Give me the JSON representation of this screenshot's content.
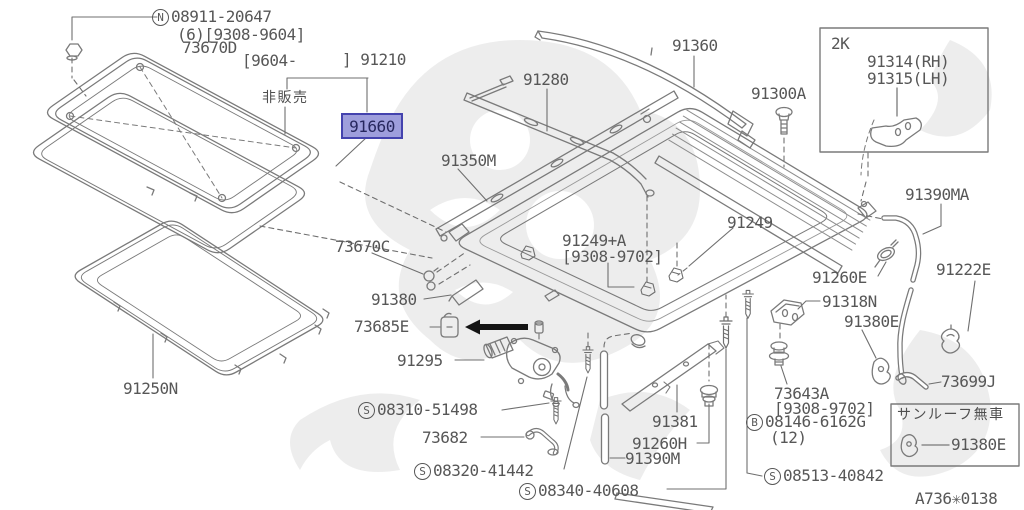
{
  "diagram_code": "A736✳0138",
  "highlight": {
    "part": "91660"
  },
  "colors": {
    "line": "#7a7a7a",
    "text": "#575757",
    "watermark": "#e4e4e4",
    "highlight_bg": "#9e9edc",
    "highlight_border": "#4443ae",
    "highlight_text": "#27275e",
    "arrow": "#141414"
  },
  "boxes": {
    "rh_lh_variant": {
      "tag": "2K"
    },
    "no_sunroof_variant": {
      "title": "サンルーフ無車"
    }
  },
  "labels": [
    {
      "name": "part-08911-20647",
      "prefix": "N",
      "text": "08911-20647",
      "x": 152,
      "y": 8,
      "inter": true
    },
    {
      "name": "note-08911-qty-range",
      "text": "(6)[9308-9604]",
      "x": 177,
      "y": 26,
      "inter": false
    },
    {
      "name": "part-73670d",
      "text": "73670D",
      "x": 182,
      "y": 39,
      "inter": true
    },
    {
      "name": "note-date-open",
      "text": "[9604-",
      "x": 242,
      "y": 52,
      "inter": false
    },
    {
      "name": "part-91210",
      "text": "] 91210",
      "x": 342,
      "y": 51,
      "inter": true
    },
    {
      "name": "note-not-sold",
      "text": "非販売",
      "x": 262,
      "y": 90,
      "cls": "jp",
      "inter": false
    },
    {
      "name": "part-91360",
      "text": "91360",
      "x": 672,
      "y": 37,
      "inter": true
    },
    {
      "name": "part-91280",
      "text": "91280",
      "x": 523,
      "y": 71,
      "inter": true
    },
    {
      "name": "part-91300a",
      "text": "91300A",
      "x": 751,
      "y": 85,
      "inter": true
    },
    {
      "name": "box-2k-tag",
      "text": "2K",
      "x": 831,
      "y": 35,
      "inter": false
    },
    {
      "name": "part-91314-rh",
      "text": "91314(RH)",
      "x": 867,
      "y": 53,
      "inter": true
    },
    {
      "name": "part-91315-lh",
      "text": "91315(LH)",
      "x": 867,
      "y": 70,
      "inter": true
    },
    {
      "name": "part-91350m",
      "text": "91350M",
      "x": 441,
      "y": 152,
      "inter": true
    },
    {
      "name": "part-91390ma",
      "text": "91390MA",
      "x": 905,
      "y": 186,
      "inter": true
    },
    {
      "name": "part-91249",
      "text": "91249",
      "x": 727,
      "y": 214,
      "inter": true
    },
    {
      "name": "part-91249-a",
      "text": "91249+A",
      "x": 562,
      "y": 232,
      "inter": true
    },
    {
      "name": "note-91249a-range",
      "text": "[9308-9702]",
      "x": 562,
      "y": 248,
      "inter": false
    },
    {
      "name": "part-73670c",
      "text": "73670C",
      "x": 335,
      "y": 238,
      "inter": true
    },
    {
      "name": "part-91222e",
      "text": "91222E",
      "x": 936,
      "y": 261,
      "inter": true
    },
    {
      "name": "part-91260e",
      "text": "91260E",
      "x": 812,
      "y": 269,
      "inter": true
    },
    {
      "name": "part-91318n",
      "text": "91318N",
      "x": 822,
      "y": 293,
      "inter": true
    },
    {
      "name": "part-91380e-right",
      "text": "91380E",
      "x": 844,
      "y": 313,
      "inter": true
    },
    {
      "name": "part-91380",
      "text": "91380",
      "x": 371,
      "y": 291,
      "inter": true
    },
    {
      "name": "part-73685e",
      "text": "73685E",
      "x": 354,
      "y": 318,
      "inter": true
    },
    {
      "name": "part-91295",
      "text": "91295",
      "x": 397,
      "y": 352,
      "inter": true
    },
    {
      "name": "part-73699j",
      "text": "73699J",
      "x": 941,
      "y": 373,
      "inter": true
    },
    {
      "name": "part-73643a",
      "text": "73643A",
      "x": 774,
      "y": 385,
      "inter": true
    },
    {
      "name": "note-73643a-range",
      "text": "[9308-9702]",
      "x": 774,
      "y": 400,
      "inter": false
    },
    {
      "name": "part-08146-6162g",
      "prefix": "B",
      "text": "08146-6162G",
      "x": 746,
      "y": 413,
      "inter": true
    },
    {
      "name": "note-08146-qty",
      "text": "(12)",
      "x": 770,
      "y": 429,
      "inter": false
    },
    {
      "name": "part-91250n",
      "text": "91250N",
      "x": 123,
      "y": 380,
      "inter": true
    },
    {
      "name": "part-08310-51498",
      "prefix": "S",
      "text": "08310-51498",
      "x": 358,
      "y": 401,
      "inter": true
    },
    {
      "name": "part-73682",
      "text": "73682",
      "x": 422,
      "y": 429,
      "inter": true
    },
    {
      "name": "part-08320-41442",
      "prefix": "S",
      "text": "08320-41442",
      "x": 414,
      "y": 462,
      "inter": true
    },
    {
      "name": "part-91381",
      "text": "91381",
      "x": 652,
      "y": 413,
      "inter": true
    },
    {
      "name": "part-91260h",
      "text": "91260H",
      "x": 632,
      "y": 435,
      "inter": true
    },
    {
      "name": "part-91390m",
      "text": "91390M",
      "x": 625,
      "y": 450,
      "inter": true
    },
    {
      "name": "part-08340-40608",
      "prefix": "S",
      "text": "08340-40608",
      "x": 519,
      "y": 482,
      "inter": true
    },
    {
      "name": "part-08513-40842",
      "prefix": "S",
      "text": "08513-40842",
      "x": 764,
      "y": 467,
      "inter": true
    },
    {
      "name": "box-no-sunroof-title",
      "text": "サンルーフ無車",
      "x": 897,
      "y": 407,
      "cls": "jp",
      "inter": false
    },
    {
      "name": "part-91380e-box",
      "text": "91380E",
      "x": 951,
      "y": 436,
      "inter": true
    },
    {
      "name": "diagram-code",
      "text": "A736✳0138",
      "x": 915,
      "y": 490,
      "inter": false
    }
  ]
}
